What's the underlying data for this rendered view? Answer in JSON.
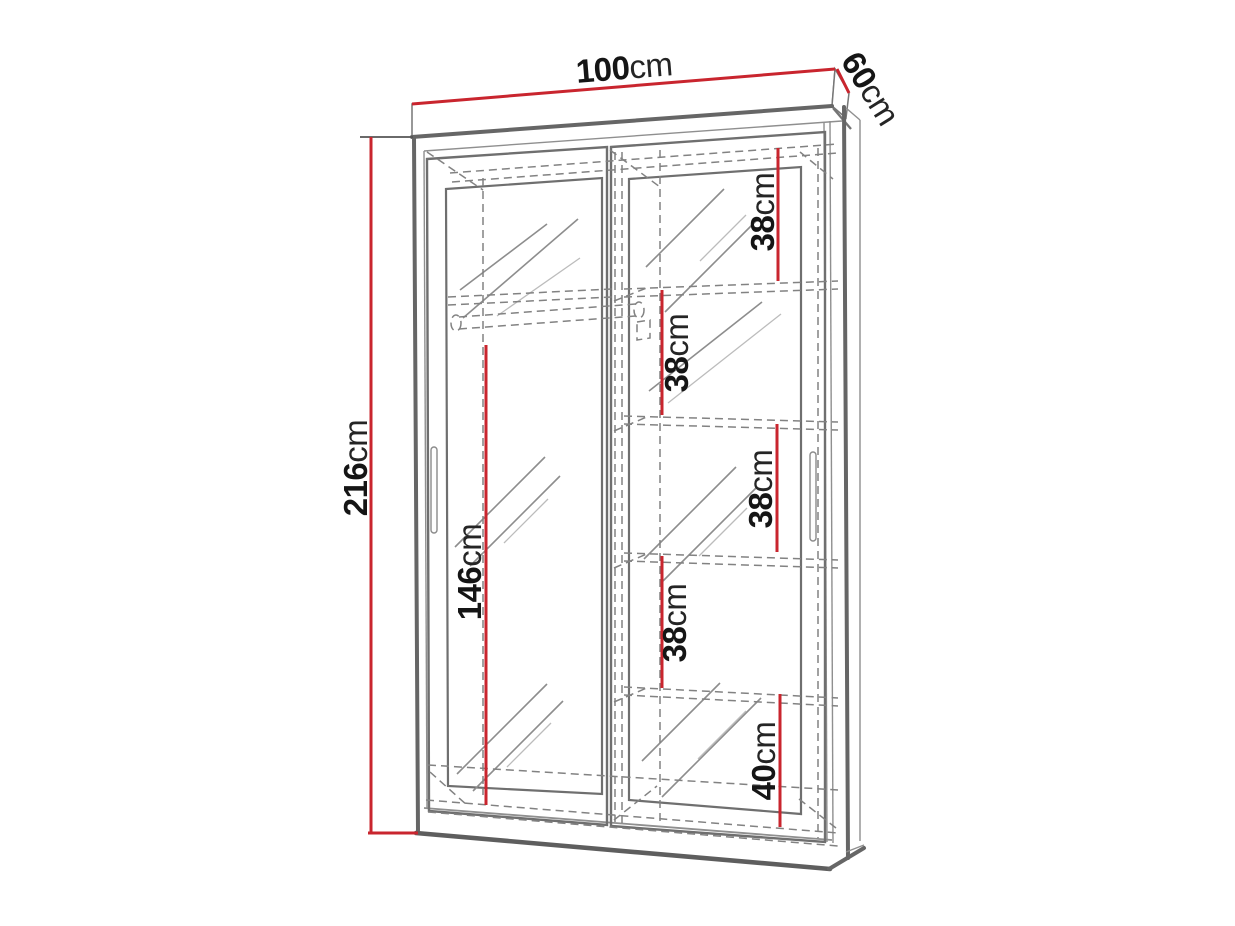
{
  "page": {
    "background": "#ffffff",
    "description": "Technical dimension drawing of a two sliding-door mirrored wardrobe with shelves and hanging rail"
  },
  "colors": {
    "dimension_red": "#c9252e",
    "outline_gray": "#666666",
    "hidden_line_gray": "#828282",
    "label_text": "#151515"
  },
  "dimensions": {
    "width": {
      "value": "100",
      "unit": "cm",
      "location": "top edge"
    },
    "depth": {
      "value": "60",
      "unit": "cm",
      "location": "top right edge"
    },
    "height": {
      "value": "216",
      "unit": "cm",
      "location": "left side"
    },
    "shelf_gap_1": {
      "value": "38",
      "unit": "cm",
      "location": "right column top section"
    },
    "shelf_gap_2": {
      "value": "38",
      "unit": "cm",
      "location": "right column second section"
    },
    "shelf_gap_3": {
      "value": "38",
      "unit": "cm",
      "location": "right column third section"
    },
    "shelf_gap_4": {
      "value": "38",
      "unit": "cm",
      "location": "right column fourth section"
    },
    "bottom_section": {
      "value": "40",
      "unit": "cm",
      "location": "right column bottom section"
    },
    "hanging_space": {
      "value": "146",
      "unit": "cm",
      "location": "left compartment below rail"
    }
  }
}
